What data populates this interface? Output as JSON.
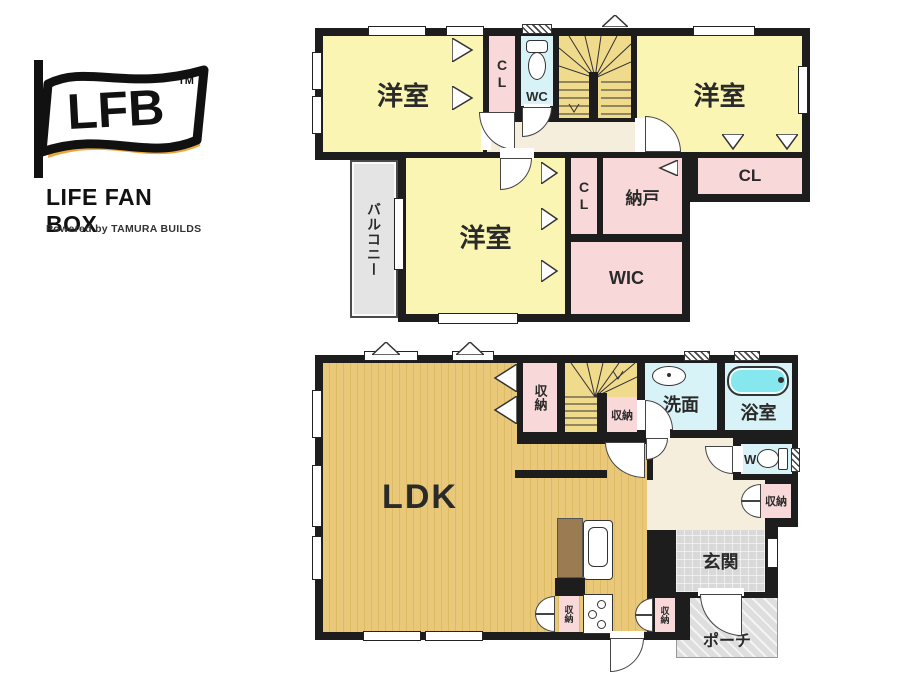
{
  "logo": {
    "acronym": "LFB",
    "trademark": "TM",
    "name": "LIFE FAN BOX",
    "powered_by": "Powered by TAMURA BUILDS"
  },
  "floor2": {
    "bedroom_nw": "洋室",
    "cl_nw": "CL",
    "wc": "WC",
    "bedroom_ne": "洋室",
    "cl_ne": "CL",
    "bedroom_sw": "洋室",
    "cl_mid": "CL",
    "nando": "納戸",
    "wic": "WIC",
    "balcony": "バルコニー"
  },
  "floor1": {
    "ldk": "LDK",
    "storage_top": "収納",
    "storage_under_stairs": "収納",
    "washroom": "洗面",
    "bathroom": "浴室",
    "wc": "WC",
    "storage_hall": "収納",
    "entrance": "玄関",
    "porch": "ポーチ",
    "storage_kitchen_left": "収納",
    "storage_kitchen_right": "収納"
  },
  "colors": {
    "wall": "#1d1d1d",
    "bedroom_yellow": "#FAF5B2",
    "stairs_yellow": "#F0DA8C",
    "ldk_tan": "#E9C979",
    "closet_pink": "#F8D8D8",
    "wet_cyan": "#D8F3F7",
    "bathtub_cyan": "#86E7EF",
    "hall_cream": "#F6EEDC",
    "gray_light": "#E4E4E4",
    "logo_gold": "#EDA63B"
  }
}
